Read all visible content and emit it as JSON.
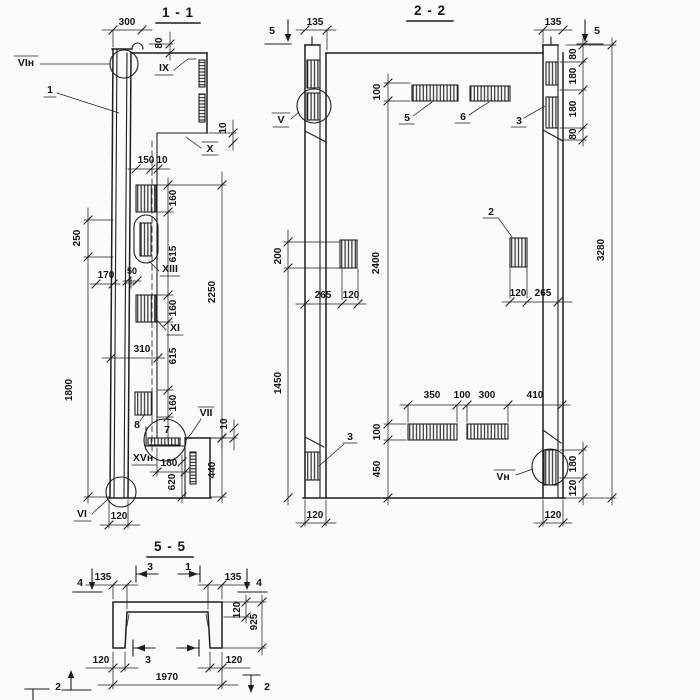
{
  "sections": {
    "s11": {
      "title": "1 - 1",
      "callouts": {
        "vi_top": "VIн",
        "pos1": "1",
        "ix": "IX",
        "x": "X",
        "xiii": "XIII",
        "xi": "XI",
        "vii": "VII",
        "xv": "XVн",
        "vi_bot": "VI",
        "pos7": "7",
        "pos8": "8"
      },
      "dims": {
        "d300": "300",
        "d80": "80",
        "d150": "150",
        "d10_mid": "10",
        "d10_top": "10",
        "d160_1": "160",
        "d615_1": "615",
        "d160_2": "160",
        "d615_2": "615",
        "d160_3": "160",
        "d2250": "2250",
        "d250": "250",
        "d170": "170",
        "d50": "50",
        "d1800": "1800",
        "d310": "310",
        "d10_r": "10",
        "d440": "440",
        "d180": "180",
        "d620": "620",
        "d120": "120"
      }
    },
    "s22": {
      "title": "2 - 2",
      "callouts": {
        "v_top": "V",
        "v_bot": "Vн",
        "pos2": "2",
        "pos3_left": "3",
        "pos3_right": "3",
        "pos5": "5",
        "pos6": "6"
      },
      "cut_marks": {
        "left5": "5",
        "right5": "5"
      },
      "dims": {
        "d135_l": "135",
        "d135_r": "135",
        "d100_top": "100",
        "d2400": "2400",
        "d100_bot": "100",
        "d450": "450",
        "d200": "200",
        "d1450": "1450",
        "d265_l": "265",
        "d120_lsq": "120",
        "d120_rsq": "120",
        "d265_r": "265",
        "d350": "350",
        "d100_gap": "100",
        "d300": "300",
        "d410": "410",
        "d80_t1": "80",
        "d180_t1": "180",
        "d180_t2": "180",
        "d80_t2": "80",
        "d180_br": "180",
        "d120_br": "120",
        "d3280": "3280",
        "d120_col_l": "120",
        "d120_col_r": "120"
      }
    },
    "s55": {
      "title": "5 - 5",
      "cut_marks": {
        "c4l": "4",
        "c4r": "4",
        "c3t": "3",
        "c1t": "1",
        "c3b": "3",
        "c2l": "2",
        "c2r": "2"
      },
      "dims": {
        "d135_l": "135",
        "d135_r": "135",
        "d120_flange": "120",
        "d925": "925",
        "d120_bl": "120",
        "d120_br": "120",
        "d1970": "1970"
      }
    }
  }
}
